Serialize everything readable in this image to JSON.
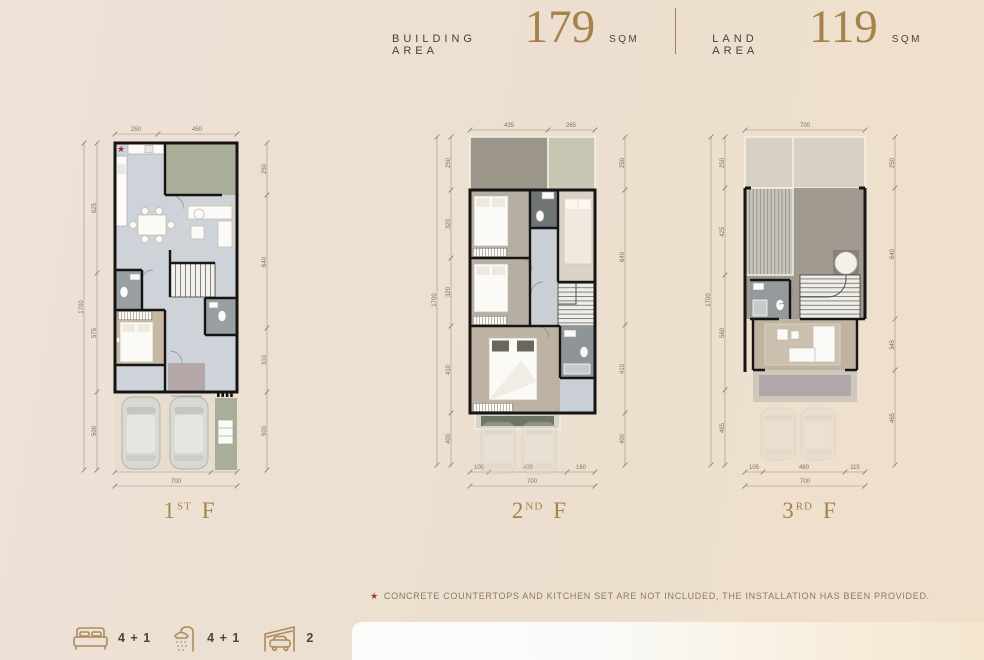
{
  "star": "★",
  "header": {
    "building_area": {
      "label": "BUILDING AREA",
      "value": "179",
      "unit": "SQM"
    },
    "land_area": {
      "label": "LAND AREA",
      "value": "119",
      "unit": "SQM"
    }
  },
  "floors": {
    "f1": {
      "name": {
        "num": "1",
        "sup": "ST",
        "word": "F"
      },
      "dims": {
        "top": [
          "250",
          "450"
        ],
        "left": [
          "625",
          "575",
          "500"
        ],
        "left_total": "1700",
        "right": [
          "250",
          "640",
          "310",
          "500"
        ],
        "bottom": [
          "550",
          "150"
        ],
        "bottom_total": "700"
      }
    },
    "f2": {
      "name": {
        "num": "2",
        "sup": "ND",
        "word": "F"
      },
      "dims": {
        "top": [
          "435",
          "265"
        ],
        "left": [
          "250",
          "320",
          "320",
          "410",
          "400"
        ],
        "left_total": "1700",
        "right": [
          "250",
          "640",
          "410",
          "400"
        ],
        "bottom": [
          "105",
          "435",
          "160"
        ],
        "bottom_total": "700"
      }
    },
    "f3": {
      "name": {
        "num": "3",
        "sup": "RD",
        "word": "F"
      },
      "dims": {
        "top": [
          "700"
        ],
        "left": [
          "250",
          "425",
          "560",
          "465"
        ],
        "left_total": "1700",
        "right": [
          "250",
          "640",
          "345",
          "465"
        ],
        "bottom": [
          "105",
          "480",
          "115"
        ],
        "bottom_total": "700"
      }
    }
  },
  "footnote": {
    "text": "CONCRETE COUNTERTOPS AND KITCHEN SET ARE NOT INCLUDED, THE INSTALLATION HAS BEEN PROVIDED."
  },
  "legend": {
    "bedrooms": "4 + 1",
    "bathrooms": "4 + 1",
    "parking": "2"
  },
  "colors": {
    "background": "#ece1d4",
    "accent_gold": "#a5824e",
    "text_dark": "#45403a",
    "dim_text": "#7b7163",
    "red_star": "#b0332b",
    "wall": "#171513",
    "floor_blue_gray": "#cdd3d8",
    "terrace_green": "#a8ae98",
    "wood": "#c0b4a0",
    "bath_gray": "#99a0a3",
    "entry_mauve": "#b3a7a7"
  }
}
